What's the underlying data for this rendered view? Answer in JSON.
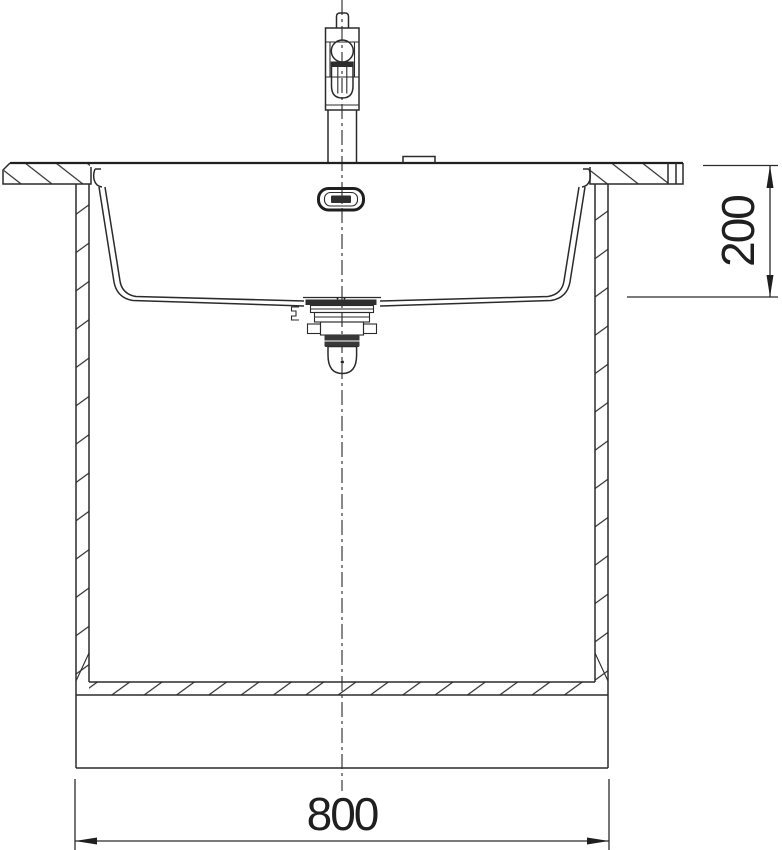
{
  "drawing": {
    "kind": "sink-section-technical-drawing",
    "colors": {
      "background": "#ffffff",
      "ink": "#2b2b2b",
      "ink_dark": "#1f1f1f"
    }
  },
  "dimensions": {
    "width": {
      "label": "800"
    },
    "depth": {
      "label": "200"
    }
  }
}
